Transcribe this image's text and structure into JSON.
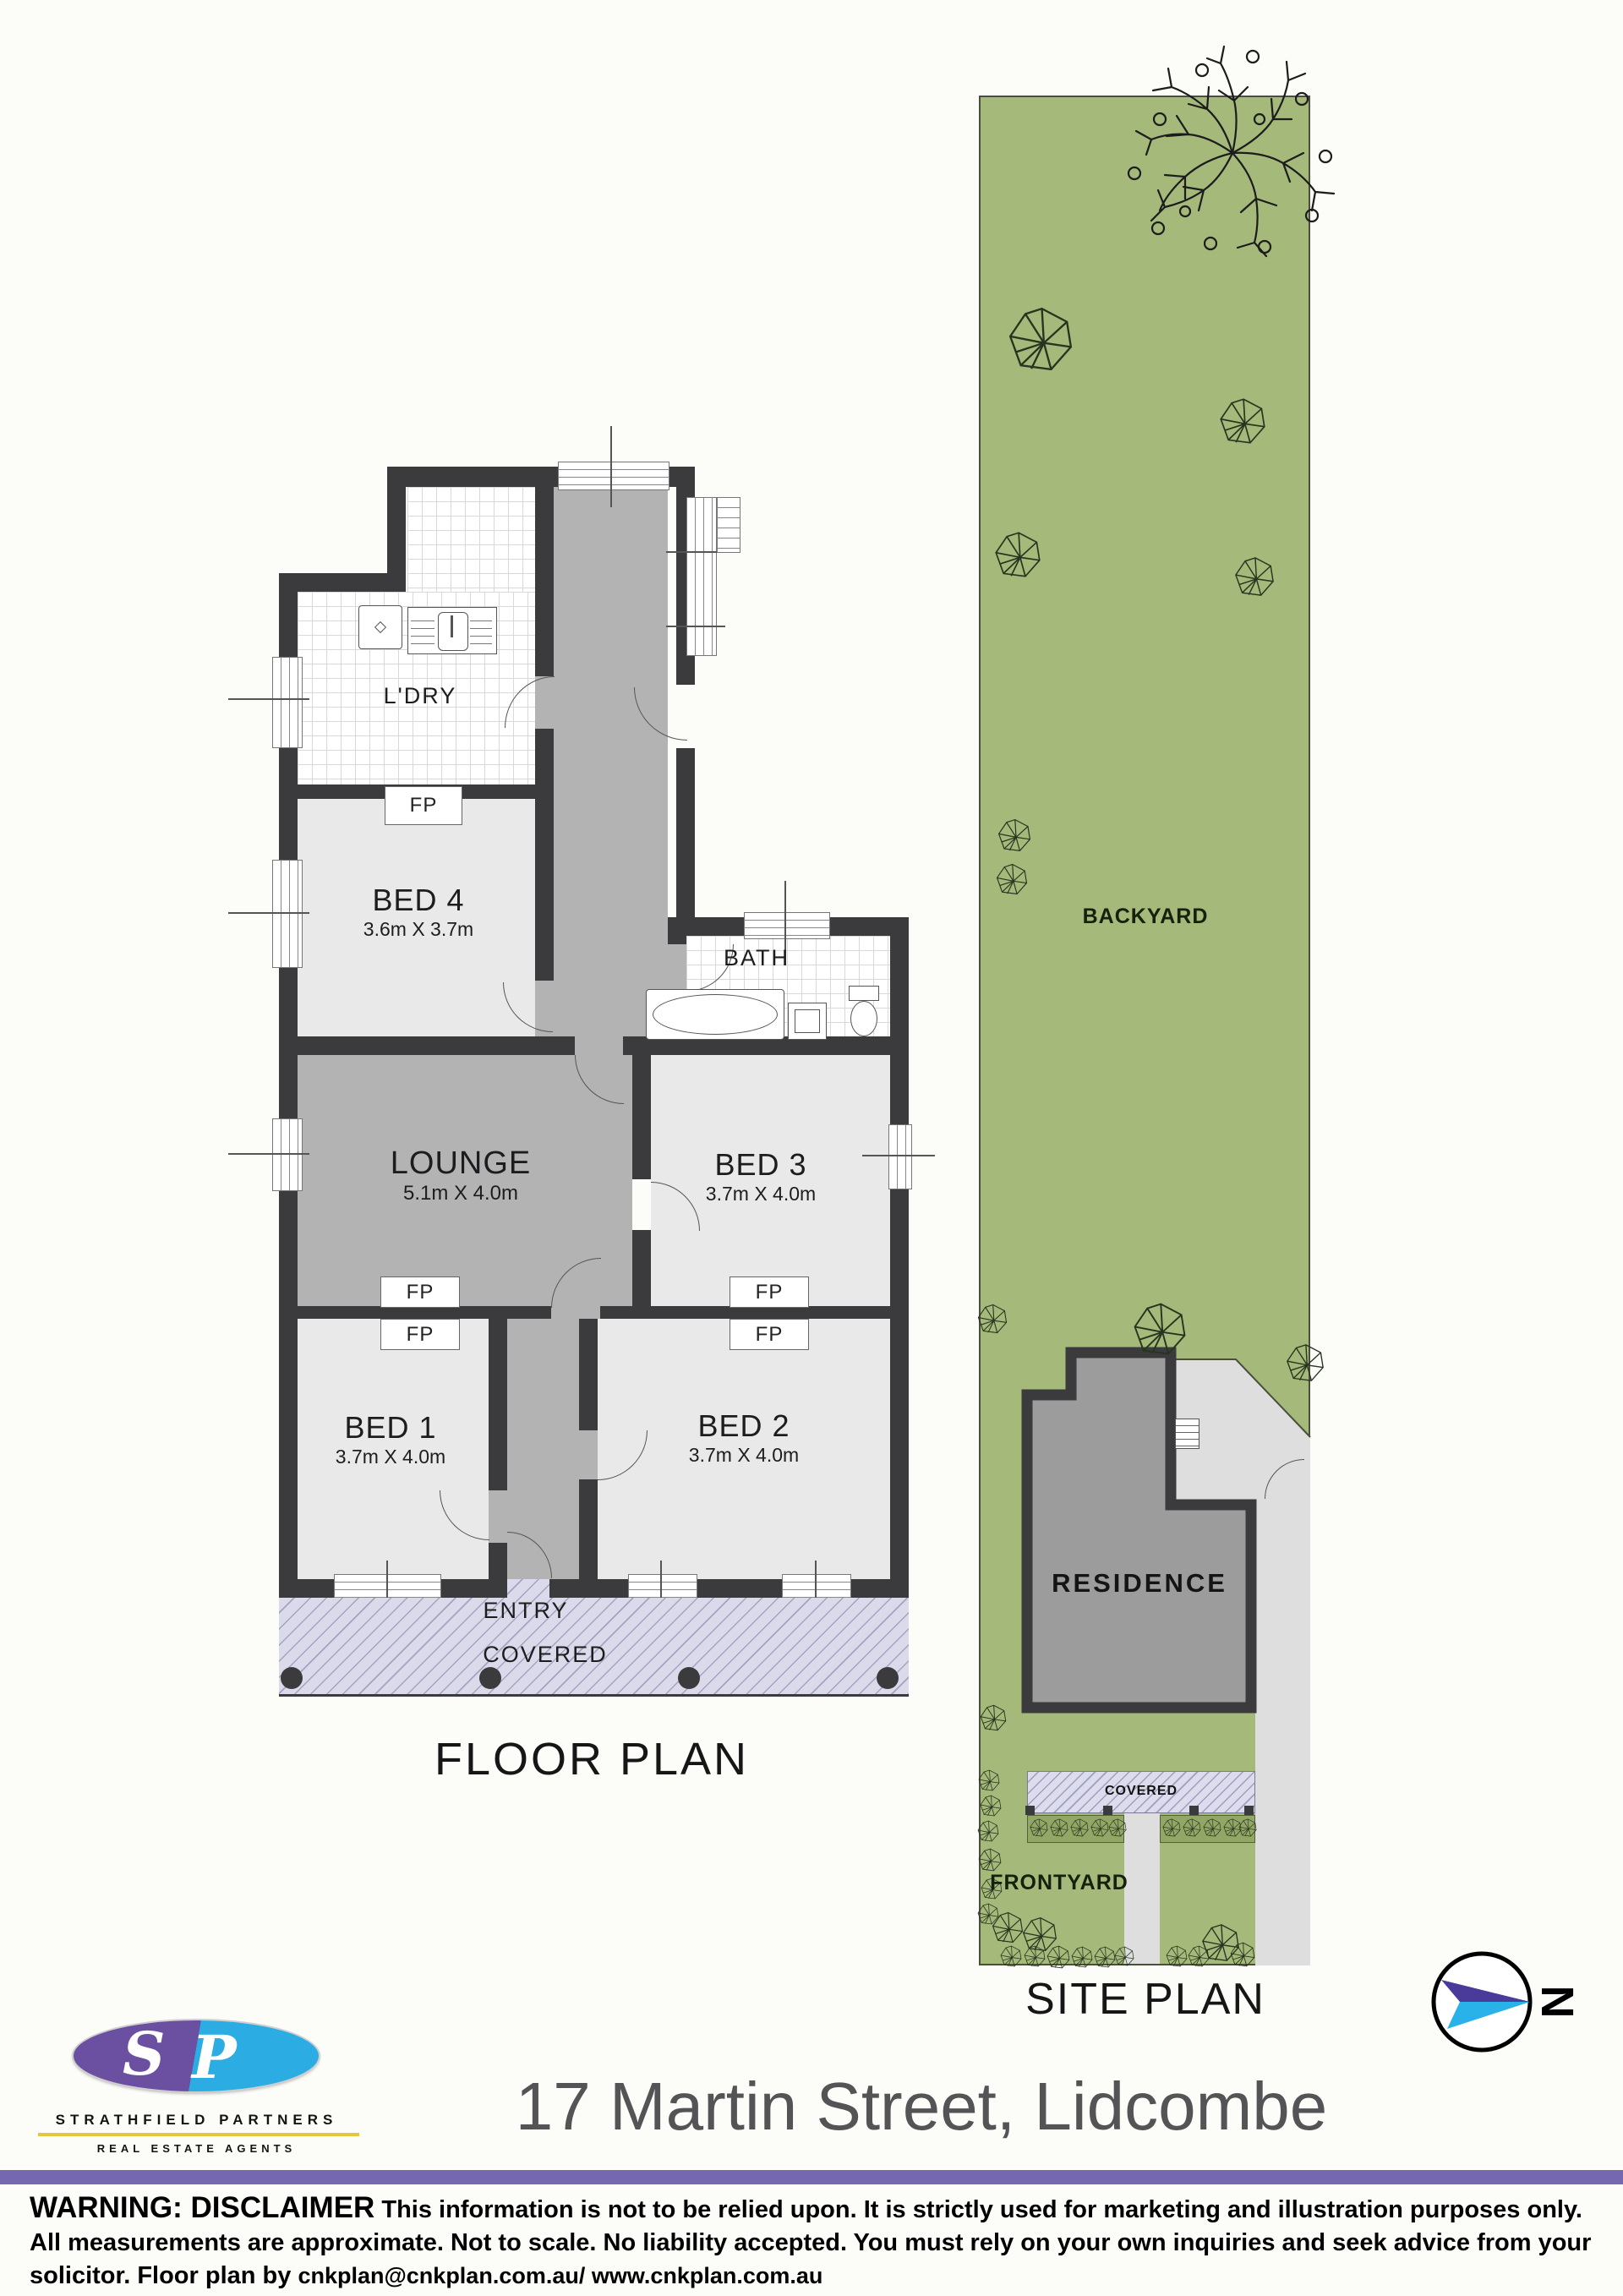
{
  "floor_plan": {
    "title": "FLOOR PLAN",
    "fp_label": "FP",
    "rooms": {
      "ldry": {
        "label": "L'DRY"
      },
      "bed4": {
        "label": "BED 4",
        "dims": "3.6m X 3.7m"
      },
      "lounge": {
        "label": "LOUNGE",
        "dims": "5.1m X 4.0m"
      },
      "bath": {
        "label": "BATH"
      },
      "bed3": {
        "label": "BED 3",
        "dims": "3.7m X 4.0m"
      },
      "bed1": {
        "label": "BED 1",
        "dims": "3.7m X 4.0m"
      },
      "bed2": {
        "label": "BED 2",
        "dims": "3.7m X 4.0m"
      },
      "entry": {
        "label": "ENTRY"
      },
      "covered": {
        "label": "COVERED"
      }
    }
  },
  "site_plan": {
    "title": "SITE PLAN",
    "labels": {
      "backyard": "BACKYARD",
      "residence": "RESIDENCE",
      "covered": "COVERED",
      "frontyard": "FRONTYARD"
    }
  },
  "north": {
    "label": "N"
  },
  "branding": {
    "logo_s": "S",
    "logo_p": "P",
    "company": "STRATHFIELD PARTNERS",
    "tagline": "REAL ESTATE AGENTS"
  },
  "address": "17 Martin Street, Lidcombe",
  "disclaimer": {
    "warning": "WARNING: DISCLAIMER",
    "line1": "This information is not to be relied upon. It is strictly used for marketing and illustration purposes only.",
    "line2": "All measurements are approximate. Not to scale. No liability accepted. You must rely on your own inquiries and seek advice from your",
    "line3_prefix": "solicitor. Floor plan by ",
    "line3_links": "cnkplan@cnkplan.com.au/ www.cnkplan.com.au"
  },
  "colors": {
    "wall": "#3b3b3d",
    "hall_gray": "#b3b3b3",
    "room_gray": "#e9e9e9",
    "porch_lavender": "#dadaeb",
    "site_green": "#a5b97a",
    "garden_bed_green": "#92a765",
    "driveway_gray": "#dedede",
    "residence_gray": "#9c9c9c",
    "bar_purple": "#7668ae",
    "logo_purple": "#6b4fa0",
    "logo_blue": "#2bace3",
    "logo_yellow": "#e6c63f",
    "arrow_purple": "#4a3a99",
    "arrow_cyan": "#29b2ea",
    "title_gray": "#545456"
  }
}
